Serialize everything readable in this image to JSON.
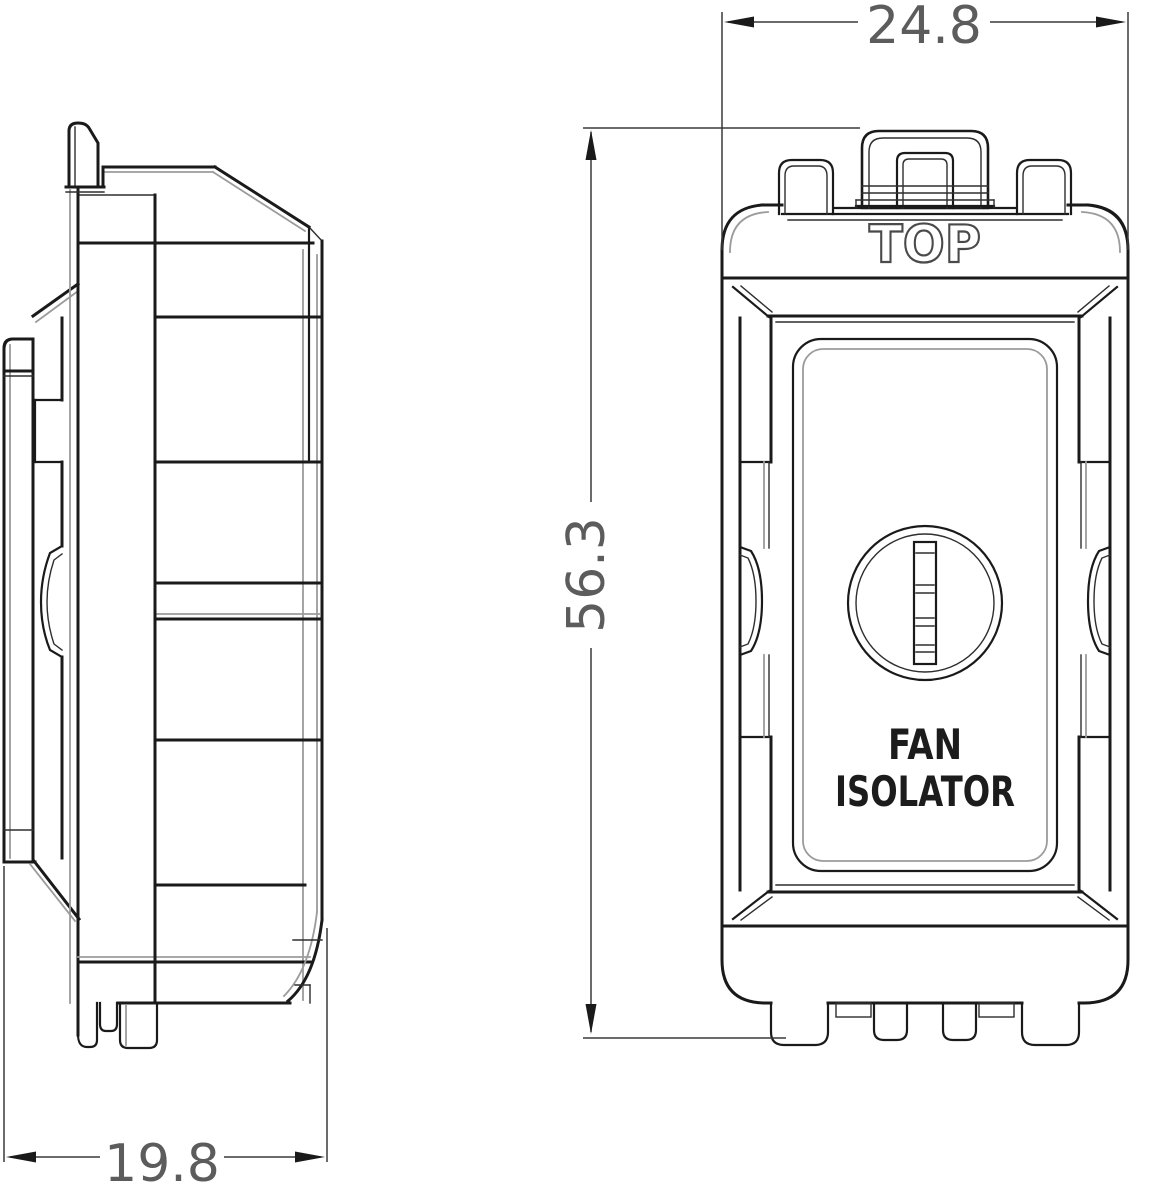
{
  "drawing": {
    "labels": {
      "top": "TOP",
      "device_line1": "FAN",
      "device_line2": "ISOLATOR"
    },
    "dimensions": {
      "width": "24.8",
      "height": "56.3",
      "depth": "19.8"
    },
    "colors": {
      "line": "#1a1a1a",
      "dim_text": "#5c5c5c",
      "outline_text": "#4a4a4a",
      "background": "#ffffff"
    }
  }
}
